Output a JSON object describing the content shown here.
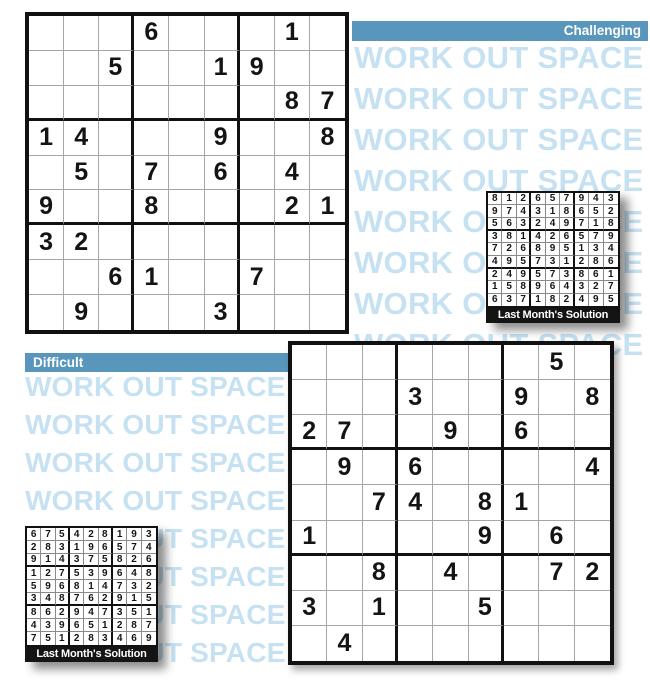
{
  "colors": {
    "bar_blue": "#5996bc",
    "watermark_blue": "#c6e2f2",
    "grid_line_gray": "#a6a6a6",
    "grid_box_black": "#111111",
    "caption_bar_black": "#141414",
    "digit_black": "#141414"
  },
  "watermark": {
    "text": "WORK OUT SPACE",
    "right_rows": 8,
    "left_rows": 8
  },
  "puzzles": {
    "challenging": {
      "label": "Challenging",
      "grid": [
        "...6...1.",
        "..5..19..",
        ".......87",
        "14...9..8",
        ".5.7.6.4.",
        "9..8...21",
        "32.......",
        "..61..7..",
        ".9...3..."
      ]
    },
    "difficult": {
      "label": "Difficult",
      "grid": [
        ".......5.",
        "...3..9.8",
        "27..9.6..",
        ".9.6....4",
        "..74.81..",
        "1....9.6.",
        "..8.4..72",
        "3.1..5...",
        ".4......."
      ]
    }
  },
  "solutions": {
    "challenging": {
      "caption": "Last Month's Solution",
      "grid": [
        "812657943",
        "974318652",
        "563249718",
        "381426579",
        "726895134",
        "495731286",
        "249573861",
        "158964327",
        "637182495"
      ]
    },
    "difficult": {
      "caption": "Last Month's Solution",
      "grid": [
        "675428193",
        "283196574",
        "914375826",
        "127539648",
        "596814732",
        "348762915",
        "862947351",
        "439651287",
        "751283469"
      ]
    }
  }
}
